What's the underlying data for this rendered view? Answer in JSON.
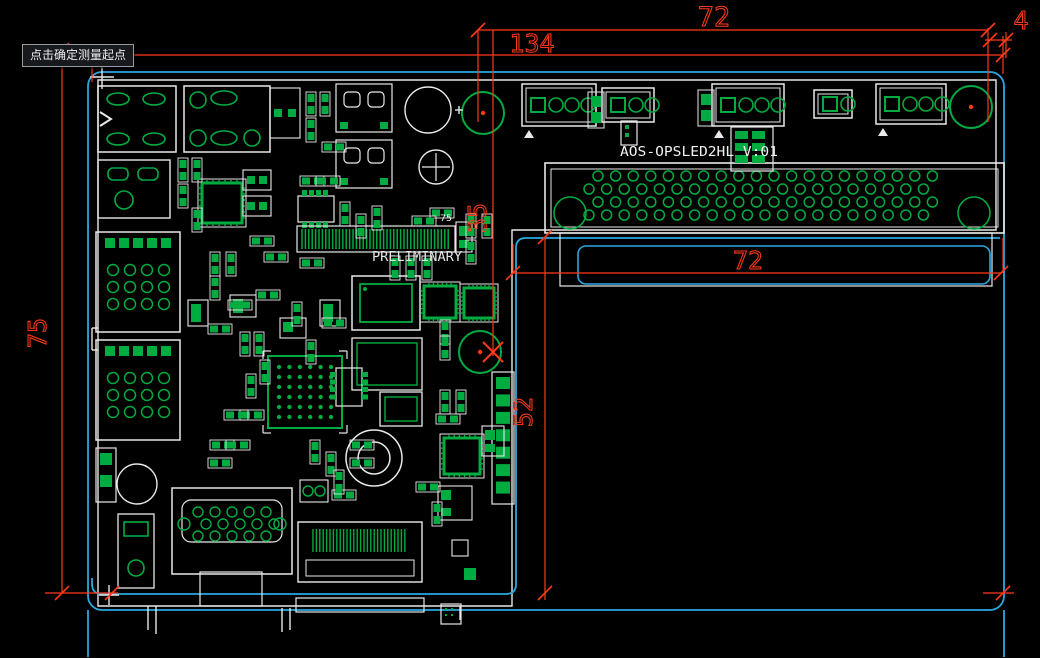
{
  "canvas": {
    "w": 1040,
    "h": 658
  },
  "colors": {
    "bg": "#000000",
    "red": "#ff3a1a",
    "blue": "#2aa9e0",
    "green": "#00ab40",
    "white": "#e9e9e9",
    "tooltip_bg": "#17191c",
    "tooltip_border": "#969ca3"
  },
  "tooltip": {
    "text": "点击确定测量起点",
    "x": 22,
    "y": 44
  },
  "texts": [
    {
      "id": "board-name-label",
      "text": "AOS-OPSLED2HL  V:01",
      "x": 620,
      "y": 156,
      "size": 13,
      "tl": 158,
      "color": "#f2f2f2"
    },
    {
      "id": "preliminary-label",
      "text": "PRELIMINARY",
      "x": 372,
      "y": 261,
      "size": 13,
      "tl": 90,
      "color": "#e6e6e6"
    },
    {
      "id": "pin-count-label",
      "text": "75",
      "x": 440,
      "y": 221,
      "size": 9,
      "tl": 12,
      "color": "#f0f0f0"
    }
  ],
  "dimensions": {
    "labels": [
      {
        "text": "72",
        "x": 714,
        "y": 26,
        "rot": 0,
        "size": 27
      },
      {
        "text": "134",
        "x": 532,
        "y": 52,
        "rot": 0,
        "size": 25
      },
      {
        "text": "4",
        "x": 1021,
        "y": 29,
        "rot": 0,
        "size": 25
      },
      {
        "text": "35",
        "x": 486,
        "y": 218,
        "rot": -90,
        "size": 25
      },
      {
        "text": "52",
        "x": 532,
        "y": 412,
        "rot": -90,
        "size": 25
      },
      {
        "text": "75",
        "x": 46,
        "y": 333,
        "rot": -90,
        "size": 25
      },
      {
        "text": "72",
        "x": 748,
        "y": 269,
        "rot": 0,
        "size": 25
      }
    ],
    "lines": [
      [
        478,
        30,
        988,
        30
      ],
      [
        62,
        55,
        1003,
        55
      ],
      [
        985,
        40,
        1012,
        40
      ],
      [
        513,
        273,
        1001,
        273
      ],
      [
        45,
        593,
        118,
        593
      ],
      [
        983,
        593,
        1014,
        593
      ],
      [
        62,
        50,
        62,
        593
      ],
      [
        92,
        66,
        92,
        82
      ],
      [
        478,
        30,
        478,
        122
      ],
      [
        493,
        30,
        493,
        356
      ],
      [
        545,
        237,
        545,
        600
      ],
      [
        988,
        28,
        988,
        122
      ],
      [
        1006,
        32,
        1006,
        58
      ],
      [
        1003,
        36,
        1003,
        74
      ],
      [
        513,
        244,
        513,
        273
      ],
      [
        1003,
        238,
        1003,
        273
      ]
    ],
    "ticks": [
      [
        478,
        30
      ],
      [
        988,
        30
      ],
      [
        62,
        55
      ],
      [
        1003,
        55
      ],
      [
        990,
        40
      ],
      [
        1006,
        40
      ],
      [
        62,
        593
      ],
      [
        112,
        593
      ],
      [
        513,
        273
      ],
      [
        1001,
        273
      ],
      [
        545,
        237
      ],
      [
        545,
        593
      ],
      [
        1003,
        593
      ],
      [
        62,
        50
      ]
    ],
    "cross": [
      [
        493,
        352
      ]
    ],
    "dots": [
      [
        971,
        107
      ],
      [
        483,
        113
      ],
      [
        480,
        352
      ]
    ]
  },
  "board_outline": {
    "white_path": "M 98 80 H 996 V 230 H 512 V 606 H 98 Z",
    "blue_outer": {
      "x": 88,
      "y": 72,
      "w": 916,
      "h": 538,
      "r": 14
    },
    "blue_inner_path": "M 92 578 V 584 Q 92 594 102 594 H 506 Q 516 594 516 584 V 248 Q 516 238 526 238 H 1000",
    "blue_slot": {
      "x": 578,
      "y": 246,
      "w": 412,
      "h": 38,
      "r": 8
    },
    "blue_lines": [
      [
        88,
        610,
        88,
        657
      ],
      [
        1004,
        610,
        1004,
        657
      ]
    ],
    "white_lines": [
      [
        90,
        77,
        114,
        77
      ],
      [
        102,
        65,
        102,
        89
      ],
      [
        99,
        595,
        119,
        595
      ],
      [
        109,
        585,
        109,
        605
      ],
      [
        148,
        606,
        148,
        630
      ],
      [
        156,
        606,
        156,
        634
      ],
      [
        282,
        608,
        282,
        632
      ],
      [
        290,
        608,
        290,
        630
      ],
      [
        98,
        328,
        92,
        328
      ],
      [
        92,
        328,
        92,
        350
      ],
      [
        92,
        350,
        98,
        350
      ],
      [
        460,
        606,
        460,
        620
      ]
    ]
  },
  "pcb": {
    "components": [
      [
        "opsconn",
        545,
        163,
        459,
        70
      ],
      [
        "tab",
        560,
        233,
        432,
        53
      ],
      [
        "conn4",
        522,
        84,
        74,
        42
      ],
      [
        "conn3",
        602,
        88,
        52,
        34
      ],
      [
        "conn4",
        712,
        84,
        72,
        42
      ],
      [
        "conn2",
        814,
        90,
        38,
        28
      ],
      [
        "conn4",
        876,
        84,
        70,
        40
      ],
      [
        "padpair",
        588,
        92,
        16,
        36
      ],
      [
        "padpair",
        698,
        90,
        16,
        36
      ],
      [
        "hdrgrid",
        731,
        127,
        42,
        44,
        2,
        3
      ],
      [
        "hdrgrid",
        621,
        121,
        16,
        24,
        1,
        2
      ],
      [
        "mark",
        524,
        130
      ],
      [
        "mark",
        714,
        130
      ],
      [
        "mark",
        878,
        128
      ],
      [
        "holeg",
        971,
        107,
        21
      ],
      [
        "holeg",
        483,
        113,
        21
      ],
      [
        "holeg",
        480,
        352,
        21
      ],
      [
        "usb",
        98,
        86,
        78,
        66
      ],
      [
        "conn4o",
        184,
        86,
        86,
        66
      ],
      [
        "jack",
        98,
        160,
        72,
        58
      ],
      [
        "smallconn",
        270,
        88,
        30,
        50
      ],
      [
        "trafo",
        336,
        84,
        56,
        48
      ],
      [
        "trafo",
        336,
        140,
        56,
        48
      ],
      [
        "capw",
        428,
        110,
        23,
        1
      ],
      [
        "capw",
        436,
        167,
        17,
        2
      ],
      [
        "qfn",
        202,
        183,
        40,
        40
      ],
      [
        "soic",
        298,
        196,
        36,
        26
      ],
      [
        "smallconn",
        243,
        170,
        28,
        20
      ],
      [
        "smallconn",
        243,
        196,
        28,
        20
      ],
      [
        "edge75",
        297,
        226,
        158,
        26
      ],
      [
        "sbox",
        456,
        222,
        16,
        30
      ],
      [
        "ddr",
        352,
        276,
        68,
        54
      ],
      [
        "qfn",
        424,
        286,
        32,
        32
      ],
      [
        "qfn",
        464,
        288,
        30,
        30
      ],
      [
        "bga",
        268,
        356,
        74,
        72
      ],
      [
        "ic",
        352,
        338,
        70,
        52
      ],
      [
        "ic",
        380,
        392,
        42,
        34
      ],
      [
        "soicv",
        336,
        368,
        26,
        38
      ],
      [
        "lan",
        96,
        232,
        84,
        100
      ],
      [
        "lan",
        96,
        340,
        84,
        100
      ],
      [
        "pinhdr",
        96,
        448,
        20,
        54
      ],
      [
        "pinhdr",
        492,
        372,
        22,
        132
      ],
      [
        "capw",
        137,
        484,
        20,
        0
      ],
      [
        "ring",
        374,
        458,
        28
      ],
      [
        "qfn",
        444,
        438,
        36,
        36
      ],
      [
        "sbox",
        482,
        426,
        22,
        30
      ],
      [
        "dsub",
        172,
        488,
        120,
        86
      ],
      [
        "tab",
        200,
        572,
        62,
        34
      ],
      [
        "tab",
        296,
        598,
        128,
        14
      ],
      [
        "hdmi",
        298,
        522,
        124,
        60
      ],
      [
        "barrel",
        118,
        514,
        36,
        74
      ],
      [
        "sbox",
        438,
        486,
        34,
        34
      ],
      [
        "sq",
        452,
        540,
        16
      ],
      [
        "gsq",
        464,
        568,
        12
      ],
      [
        "pads2c",
        300,
        480,
        28,
        22
      ],
      [
        "hdrgrid",
        441,
        604,
        20,
        20,
        2,
        2
      ],
      [
        "sbox",
        230,
        295,
        26,
        22
      ],
      [
        "sbox",
        280,
        318,
        26,
        20
      ],
      [
        "sbox",
        320,
        300,
        20,
        26
      ],
      [
        "sbox",
        188,
        300,
        20,
        26
      ]
    ],
    "passives": [
      [
        306,
        92,
        1
      ],
      [
        320,
        92,
        1
      ],
      [
        306,
        118,
        1
      ],
      [
        322,
        142,
        0
      ],
      [
        178,
        158,
        1
      ],
      [
        192,
        158,
        1
      ],
      [
        178,
        184,
        1
      ],
      [
        192,
        208,
        1
      ],
      [
        250,
        236,
        0
      ],
      [
        264,
        252,
        0
      ],
      [
        300,
        258,
        0
      ],
      [
        210,
        252,
        1
      ],
      [
        226,
        252,
        1
      ],
      [
        210,
        276,
        1
      ],
      [
        228,
        300,
        0
      ],
      [
        256,
        290,
        0
      ],
      [
        292,
        302,
        1
      ],
      [
        306,
        340,
        1
      ],
      [
        322,
        318,
        0
      ],
      [
        208,
        324,
        0
      ],
      [
        240,
        332,
        1
      ],
      [
        254,
        332,
        1
      ],
      [
        466,
        214,
        1
      ],
      [
        482,
        214,
        1
      ],
      [
        466,
        240,
        1
      ],
      [
        340,
        202,
        1
      ],
      [
        356,
        214,
        1
      ],
      [
        372,
        206,
        1
      ],
      [
        390,
        256,
        1
      ],
      [
        406,
        256,
        1
      ],
      [
        422,
        256,
        1
      ],
      [
        430,
        208,
        0
      ],
      [
        412,
        216,
        0
      ],
      [
        210,
        440,
        0
      ],
      [
        226,
        440,
        0
      ],
      [
        208,
        458,
        0
      ],
      [
        310,
        440,
        1
      ],
      [
        326,
        452,
        1
      ],
      [
        416,
        482,
        0
      ],
      [
        432,
        502,
        1
      ],
      [
        332,
        490,
        0
      ],
      [
        350,
        440,
        0
      ],
      [
        350,
        458,
        0
      ],
      [
        334,
        470,
        1
      ],
      [
        240,
        410,
        0
      ],
      [
        224,
        410,
        0
      ],
      [
        440,
        390,
        1
      ],
      [
        456,
        390,
        1
      ],
      [
        436,
        414,
        0
      ],
      [
        300,
        176,
        0
      ],
      [
        316,
        176,
        0
      ],
      [
        440,
        320,
        1
      ],
      [
        440,
        336,
        1
      ],
      [
        246,
        374,
        1
      ],
      [
        260,
        360,
        1
      ]
    ]
  }
}
